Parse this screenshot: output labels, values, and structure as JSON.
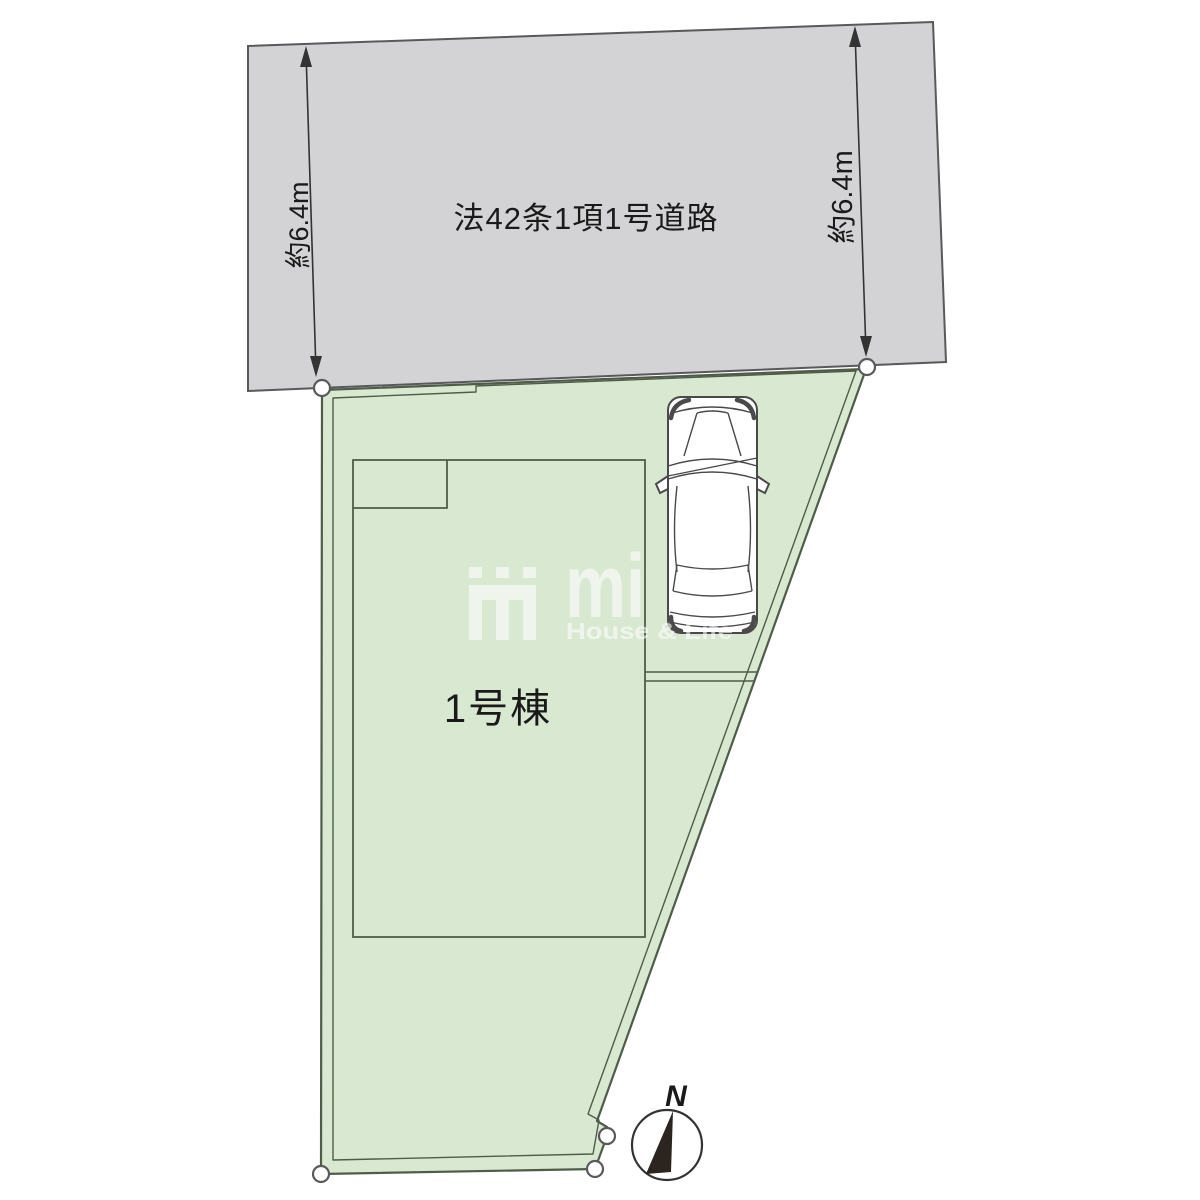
{
  "road": {
    "label": "法42条1項1号道路"
  },
  "dimensions": {
    "left": "約6.4m",
    "right": "約6.4m"
  },
  "plot": {
    "building_label": "1号棟"
  },
  "compass": {
    "label": "N"
  },
  "watermark": {
    "logo": "mi",
    "tagline": "House & Life"
  },
  "colors": {
    "road_fill": "#d3d3d5",
    "road_stroke": "#59595c",
    "plot_fill": "#d9e8d1",
    "plot_stroke": "#4e5c49",
    "line": "#333333",
    "text": "#1a1a1a",
    "needle": "#2b241f",
    "car_stroke": "#4a4a4a",
    "watermark": "#ffffff"
  }
}
